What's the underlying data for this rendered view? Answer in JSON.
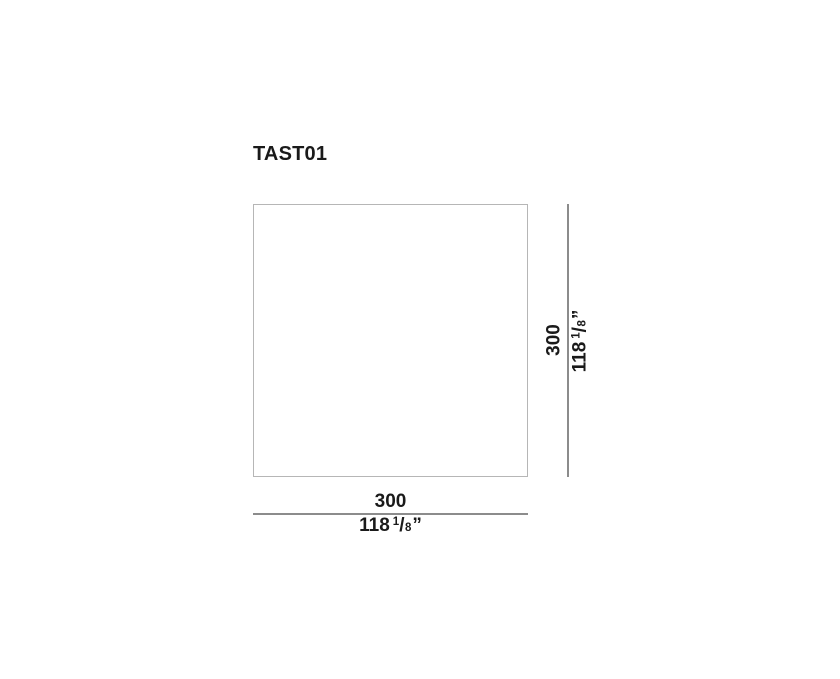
{
  "page": {
    "background_color": "#ffffff"
  },
  "colors": {
    "text": "#1a1a1a",
    "product_outline": "#b6b6b6",
    "dimension_line": "#8c8c8c"
  },
  "product": {
    "code": "TAST01"
  },
  "dimensions": {
    "height": {
      "metric": "300",
      "imperial": {
        "whole": "118",
        "numerator": "1",
        "slash": "/",
        "denominator": "8",
        "unit": "”"
      }
    },
    "width": {
      "metric": "300",
      "imperial": {
        "whole": "118",
        "numerator": "1",
        "slash": "/",
        "denominator": "8",
        "unit": "”"
      }
    }
  }
}
